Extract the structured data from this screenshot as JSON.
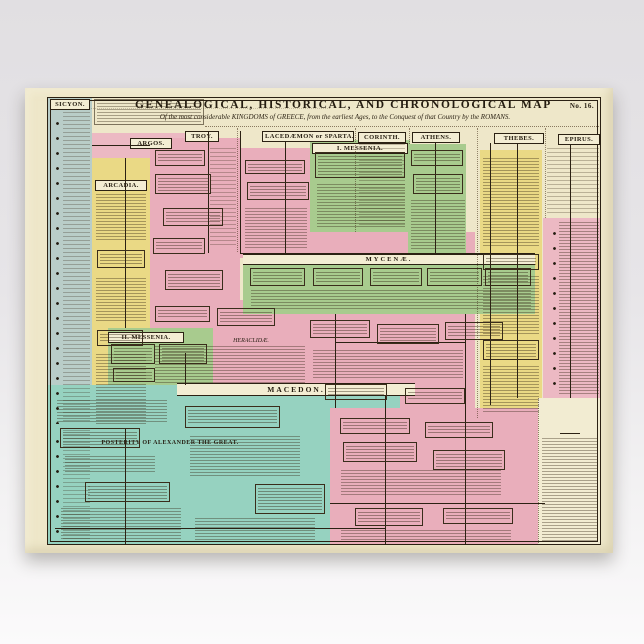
{
  "poster": {
    "plate_no": "No. 16.",
    "title": "GENEALOGICAL, HISTORICAL, AND CHRONOLOGICAL MAP",
    "subtitle": "Of the most considerable KINGDOMS of GREECE, from the earliest Ages, to the Conquest of that Country by the ROMANS.",
    "sections": {
      "sicyon": "SICYON.",
      "argos": "ARGOS.",
      "arcadia": "ARCADIA.",
      "troy": "TROY.",
      "lacedaemon": "LACEDÆMON or SPARTA.",
      "messenia1": "I. MESSENIA.",
      "corinth": "CORINTH.",
      "athens": "ATHENS.",
      "thebes": "THEBES.",
      "epirus": "EPIRUS.",
      "mycenae": "MYCENÆ.",
      "messenia2": "II. MESSENIA.",
      "heraclidae": "HERACLIDÆ.",
      "macedon": "MACEDON.",
      "posterity": "POSTERITY OF ALEXANDER THE GREAT.",
      "epochas": {
        "line1": "EPOCHAS",
        "line2": "of the",
        "line3": "HISTORY OF GREECE."
      }
    }
  }
}
